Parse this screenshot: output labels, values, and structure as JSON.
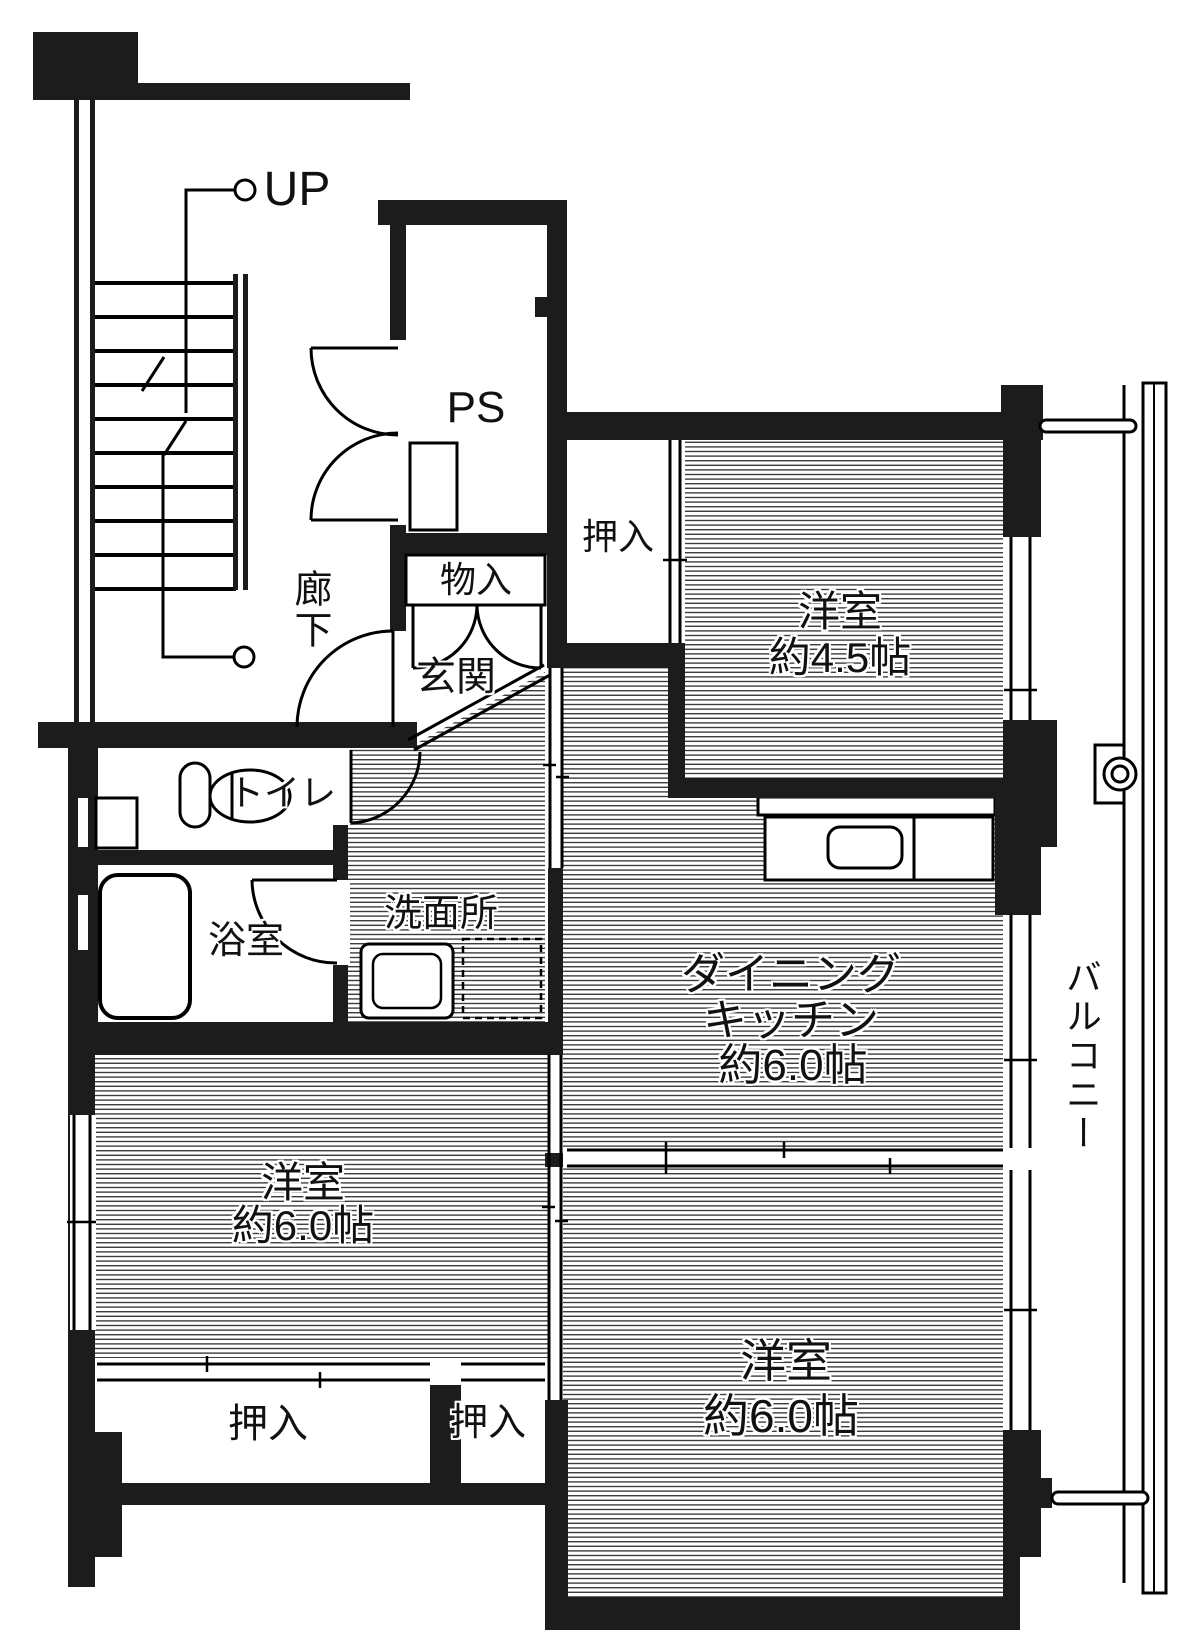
{
  "floorplan": {
    "stairs": {
      "up_label": "UP"
    },
    "corridor": {
      "label": "廊下"
    },
    "pipe_space": {
      "label": "PS"
    },
    "storage": {
      "label": "物入"
    },
    "entrance": {
      "label": "玄関"
    },
    "closet_top": {
      "label": "押入"
    },
    "closet_bottom_left": {
      "label": "押入"
    },
    "closet_bottom_center": {
      "label": "押入"
    },
    "toilet": {
      "label": "トイレ"
    },
    "bathroom": {
      "label": "浴室"
    },
    "washroom": {
      "label": "洗面所"
    },
    "dining_kitchen": {
      "label_line1": "ダイニング",
      "label_line2": "キッチン",
      "size": "約6.0帖"
    },
    "western_room_small": {
      "label": "洋室",
      "size": "約4.5帖"
    },
    "western_room_left": {
      "label": "洋室",
      "size": "約6.0帖"
    },
    "western_room_right": {
      "label": "洋室",
      "size": "約6.0帖"
    },
    "balcony": {
      "label": "バルコニー"
    },
    "colors": {
      "wall": "#1c1c1c",
      "line": "#000000",
      "hatch_line": "#3d3d3d",
      "background": "#ffffff"
    }
  }
}
